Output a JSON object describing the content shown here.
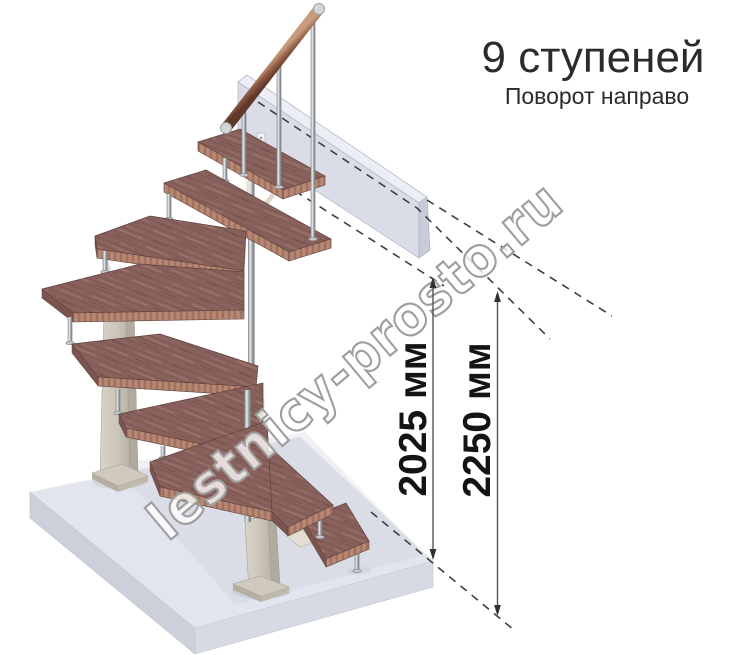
{
  "title": {
    "heading": "9 ступеней",
    "subheading": "Поворот направо"
  },
  "watermark": {
    "text": "lestnicy-prosto.ru"
  },
  "dimensions": [
    {
      "label": "2025 мм"
    },
    {
      "label": "2250 мм"
    }
  ],
  "illustration": {
    "description": "3D render of a modular staircase with 9 treads turning right, wooden treads, metal balusters, wooden handrail, support columns on a floor slab, upper floor beam",
    "colors": {
      "tread_wood": "#8a625d",
      "tread_edge": "#b0806c",
      "column_beige": "#ccc6bb",
      "metal": "#c6c9ce",
      "floor_slab": "#e2e4ec",
      "upper_beam": "#d8dbe7",
      "dashed_line": "#3c4045",
      "dimension_ink": "#141414",
      "title_ink": "#2b2b2b",
      "watermark_outline": "#9e9e9e"
    }
  }
}
